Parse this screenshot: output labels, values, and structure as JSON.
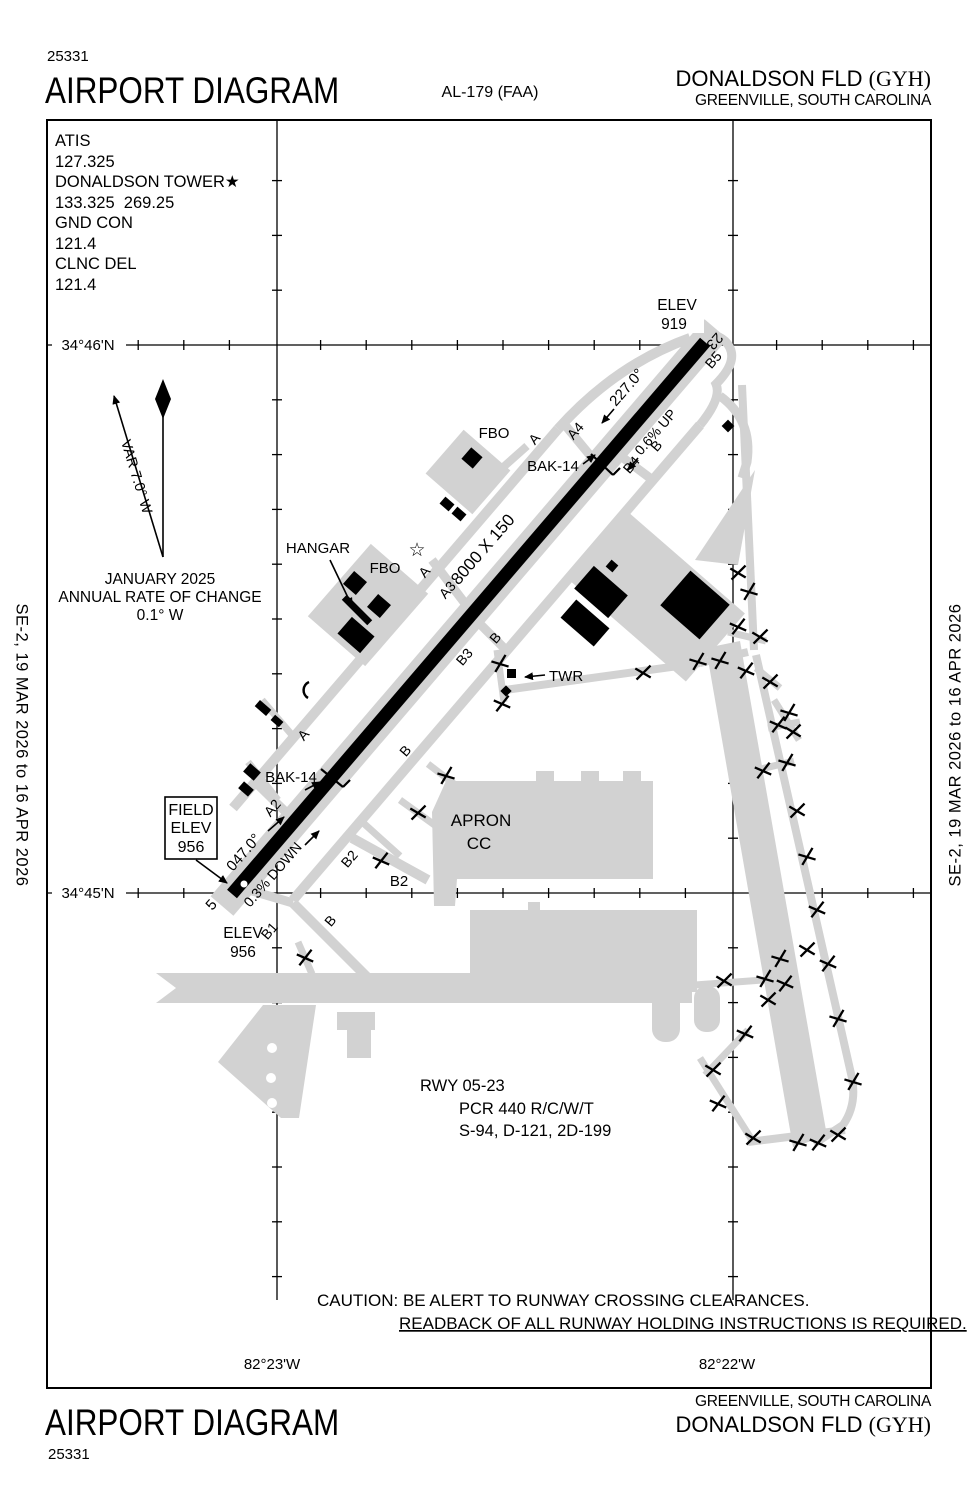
{
  "header": {
    "chart_number": "25331",
    "title": "AIRPORT DIAGRAM",
    "procedure_id": "AL-179 (FAA)",
    "airport_name": "DONALDSON FLD ",
    "airport_icao": "(GYH)",
    "city": "GREENVILLE, SOUTH CAROLINA"
  },
  "footer": {
    "chart_number": "25331",
    "title": "AIRPORT DIAGRAM",
    "airport_name": "DONALDSON FLD ",
    "airport_icao": "(GYH)",
    "city": "GREENVILLE, SOUTH CAROLINA"
  },
  "edition": {
    "left": "SE-2,  19 MAR 2026  to  16 APR 2026",
    "right": "SE-2,  19 MAR 2026  to  16 APR 2026"
  },
  "comm": {
    "lines": [
      "ATIS",
      "127.325",
      "DONALDSON TOWER★",
      "133.325  269.25",
      "GND CON",
      "121.4",
      "CLNC DEL",
      "121.4"
    ]
  },
  "grid": {
    "lat_top": "34°46'N",
    "lat_bottom": "34°45'N",
    "lon_left": "82°23'W",
    "lon_right": "82°22'W"
  },
  "colors": {
    "pavement": "#d2d2d2",
    "runway": "#000000",
    "background": "#ffffff"
  },
  "map_labels": [
    {
      "t": "ELEV",
      "x": 677,
      "y": 310,
      "s": 15.5
    },
    {
      "t": "919",
      "x": 674,
      "y": 329,
      "s": 15.5
    },
    {
      "t": "23",
      "x": 711,
      "y": 338,
      "r": 131,
      "s": 15
    },
    {
      "t": "B5",
      "x": 717,
      "y": 363,
      "r": -49,
      "s": 14
    },
    {
      "t": "227.0°",
      "x": 616,
      "y": 407,
      "r": -49,
      "a": "start",
      "s": 15
    },
    {
      "t": "0.6% UP",
      "x": 641,
      "y": 456,
      "r": -49,
      "a": "start",
      "s": 14
    },
    {
      "t": "B",
      "x": 660,
      "y": 449,
      "r": -49,
      "s": 14
    },
    {
      "t": "A4",
      "x": 579,
      "y": 434,
      "r": -49,
      "s": 14
    },
    {
      "t": "B4",
      "x": 635,
      "y": 468,
      "r": -49,
      "s": 14
    },
    {
      "t": "FBO",
      "x": 494,
      "y": 438,
      "s": 15
    },
    {
      "t": "A",
      "x": 538,
      "y": 442,
      "r": -49,
      "s": 14
    },
    {
      "t": "BAK-14",
      "x": 553,
      "y": 471,
      "s": 15
    },
    {
      "t": "8000 X 150",
      "x": 487,
      "y": 553,
      "r": -49,
      "s": 17
    },
    {
      "t": "HANGAR",
      "x": 318,
      "y": 553,
      "s": 15
    },
    {
      "t": "FBO",
      "x": 385,
      "y": 573,
      "s": 15
    },
    {
      "t": "☆",
      "x": 417,
      "y": 556,
      "s": 19
    },
    {
      "t": "A",
      "x": 428,
      "y": 575,
      "r": -49,
      "s": 14
    },
    {
      "t": "A3",
      "x": 451,
      "y": 593,
      "r": -49,
      "s": 14
    },
    {
      "t": "B",
      "x": 499,
      "y": 641,
      "r": -49,
      "s": 14
    },
    {
      "t": "B3",
      "x": 468,
      "y": 660,
      "r": -49,
      "s": 14
    },
    {
      "t": "TWR",
      "x": 549,
      "y": 681,
      "a": "start",
      "s": 15
    },
    {
      "t": "A",
      "x": 307,
      "y": 738,
      "r": -49,
      "s": 14
    },
    {
      "t": "B",
      "x": 409,
      "y": 754,
      "r": -49,
      "s": 14
    },
    {
      "t": "BAK-14",
      "x": 291,
      "y": 782,
      "s": 15
    },
    {
      "t": "A2",
      "x": 276,
      "y": 811,
      "r": -49,
      "s": 14
    },
    {
      "t": "047.0°",
      "x": 233,
      "y": 872,
      "r": -49,
      "a": "start",
      "s": 15
    },
    {
      "t": "0.3% DOWN",
      "x": 250,
      "y": 908,
      "r": -49,
      "a": "start",
      "s": 14
    },
    {
      "t": "B2",
      "x": 353,
      "y": 862,
      "r": -49,
      "s": 14
    },
    {
      "t": "B2",
      "x": 399,
      "y": 886,
      "s": 15
    },
    {
      "t": "APRON",
      "x": 481,
      "y": 826,
      "s": 17
    },
    {
      "t": "CC",
      "x": 479,
      "y": 849,
      "s": 17
    },
    {
      "t": "5",
      "x": 215,
      "y": 908,
      "r": -49,
      "s": 15
    },
    {
      "t": "ELEV",
      "x": 243,
      "y": 938,
      "s": 15.5
    },
    {
      "t": "956",
      "x": 243,
      "y": 957,
      "s": 15.5
    },
    {
      "t": "B1",
      "x": 273,
      "y": 934,
      "r": -49,
      "s": 14
    },
    {
      "t": "B",
      "x": 334,
      "y": 924,
      "r": -49,
      "s": 14
    },
    {
      "t": "FIELD",
      "x": 191,
      "y": 815,
      "s": 16
    },
    {
      "t": "ELEV",
      "x": 191,
      "y": 833,
      "s": 16
    },
    {
      "t": "956",
      "x": 191,
      "y": 852,
      "s": 16
    },
    {
      "t": "VAR 7.0° W",
      "x": 132,
      "y": 478,
      "r": 73,
      "s": 14.5
    },
    {
      "t": "JANUARY 2025",
      "x": 160,
      "y": 584,
      "s": 15.5
    },
    {
      "t": "ANNUAL RATE OF CHANGE",
      "x": 160,
      "y": 602,
      "s": 15.5
    },
    {
      "t": "0.1° W",
      "x": 160,
      "y": 620,
      "s": 15.5
    },
    {
      "t": "34°46'N",
      "x": 88,
      "y": 350,
      "s": 15
    },
    {
      "t": "34°45'N",
      "x": 88,
      "y": 898,
      "s": 15
    },
    {
      "t": "82°23'W",
      "x": 272,
      "y": 1369,
      "s": 15
    },
    {
      "t": "82°22'W",
      "x": 727,
      "y": 1369,
      "s": 15
    },
    {
      "t": "RWY 05-23",
      "x": 420,
      "y": 1091,
      "a": "start",
      "s": 16.5
    },
    {
      "t": "PCR 440 R/C/W/T",
      "x": 459,
      "y": 1114,
      "a": "start",
      "s": 16.5
    },
    {
      "t": "S-94, D-121, 2D-199",
      "x": 459,
      "y": 1136,
      "a": "start",
      "s": 16.5
    },
    {
      "t": "CAUTION: BE ALERT TO RUNWAY CROSSING CLEARANCES.",
      "x": 317,
      "y": 1306,
      "a": "start",
      "s": 17
    },
    {
      "t": "READBACK OF ALL RUNWAY HOLDING INSTRUCTIONS IS REQUIRED.",
      "x": 399,
      "y": 1329,
      "a": "start",
      "s": 17,
      "u": true
    }
  ],
  "x_marks": [
    [
      500,
      664
    ],
    [
      502,
      704
    ],
    [
      643,
      673
    ],
    [
      698,
      662
    ],
    [
      381,
      861
    ],
    [
      418,
      813
    ],
    [
      446,
      776
    ],
    [
      305,
      958
    ],
    [
      738,
      573
    ],
    [
      749,
      592
    ],
    [
      738,
      627
    ],
    [
      760,
      637
    ],
    [
      720,
      661
    ],
    [
      746,
      671
    ],
    [
      770,
      682
    ],
    [
      789,
      713
    ],
    [
      778,
      725
    ],
    [
      793,
      732
    ],
    [
      787,
      763
    ],
    [
      763,
      771
    ],
    [
      797,
      811
    ],
    [
      807,
      857
    ],
    [
      817,
      910
    ],
    [
      807,
      950
    ],
    [
      780,
      959
    ],
    [
      828,
      964
    ],
    [
      724,
      981
    ],
    [
      765,
      979
    ],
    [
      785,
      984
    ],
    [
      768,
      1000
    ],
    [
      838,
      1019
    ],
    [
      745,
      1034
    ],
    [
      713,
      1070
    ],
    [
      853,
      1082
    ],
    [
      718,
      1104
    ],
    [
      753,
      1138
    ],
    [
      798,
      1143
    ],
    [
      818,
      1143
    ],
    [
      838,
      1135
    ]
  ]
}
